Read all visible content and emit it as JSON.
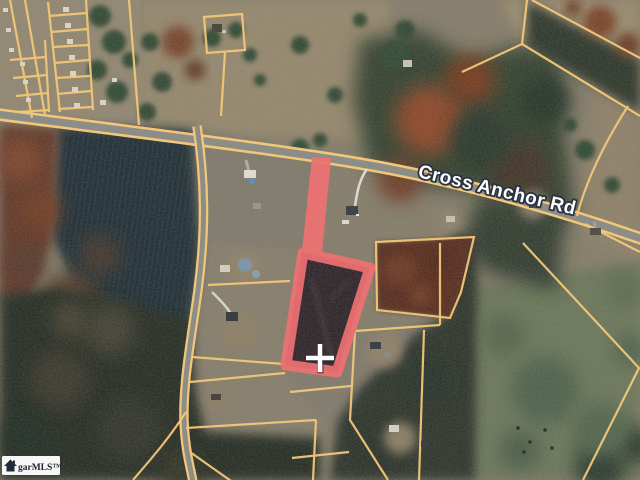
{
  "map": {
    "kind": "satellite-parcel-map",
    "road_label": "Cross Anchor Rd",
    "watermark_text": "garMLS™",
    "marker": {
      "shape": "plus-cross",
      "x": 320,
      "y": 358,
      "color": "#ffffff"
    },
    "highlighted_parcel": {
      "shape": "flag-lot",
      "outline_color": "#ef7173",
      "location": "south side of Cross Anchor Rd"
    },
    "colors": {
      "parcel_line": "#f2c779",
      "road_surface": "#8d8d87",
      "pine_forest": "#1b2c30",
      "mixed_forest": "#242c24",
      "field_tan": "#877e6a",
      "pasture_green": "#697459",
      "autumn_rust": "#7c4229"
    }
  }
}
